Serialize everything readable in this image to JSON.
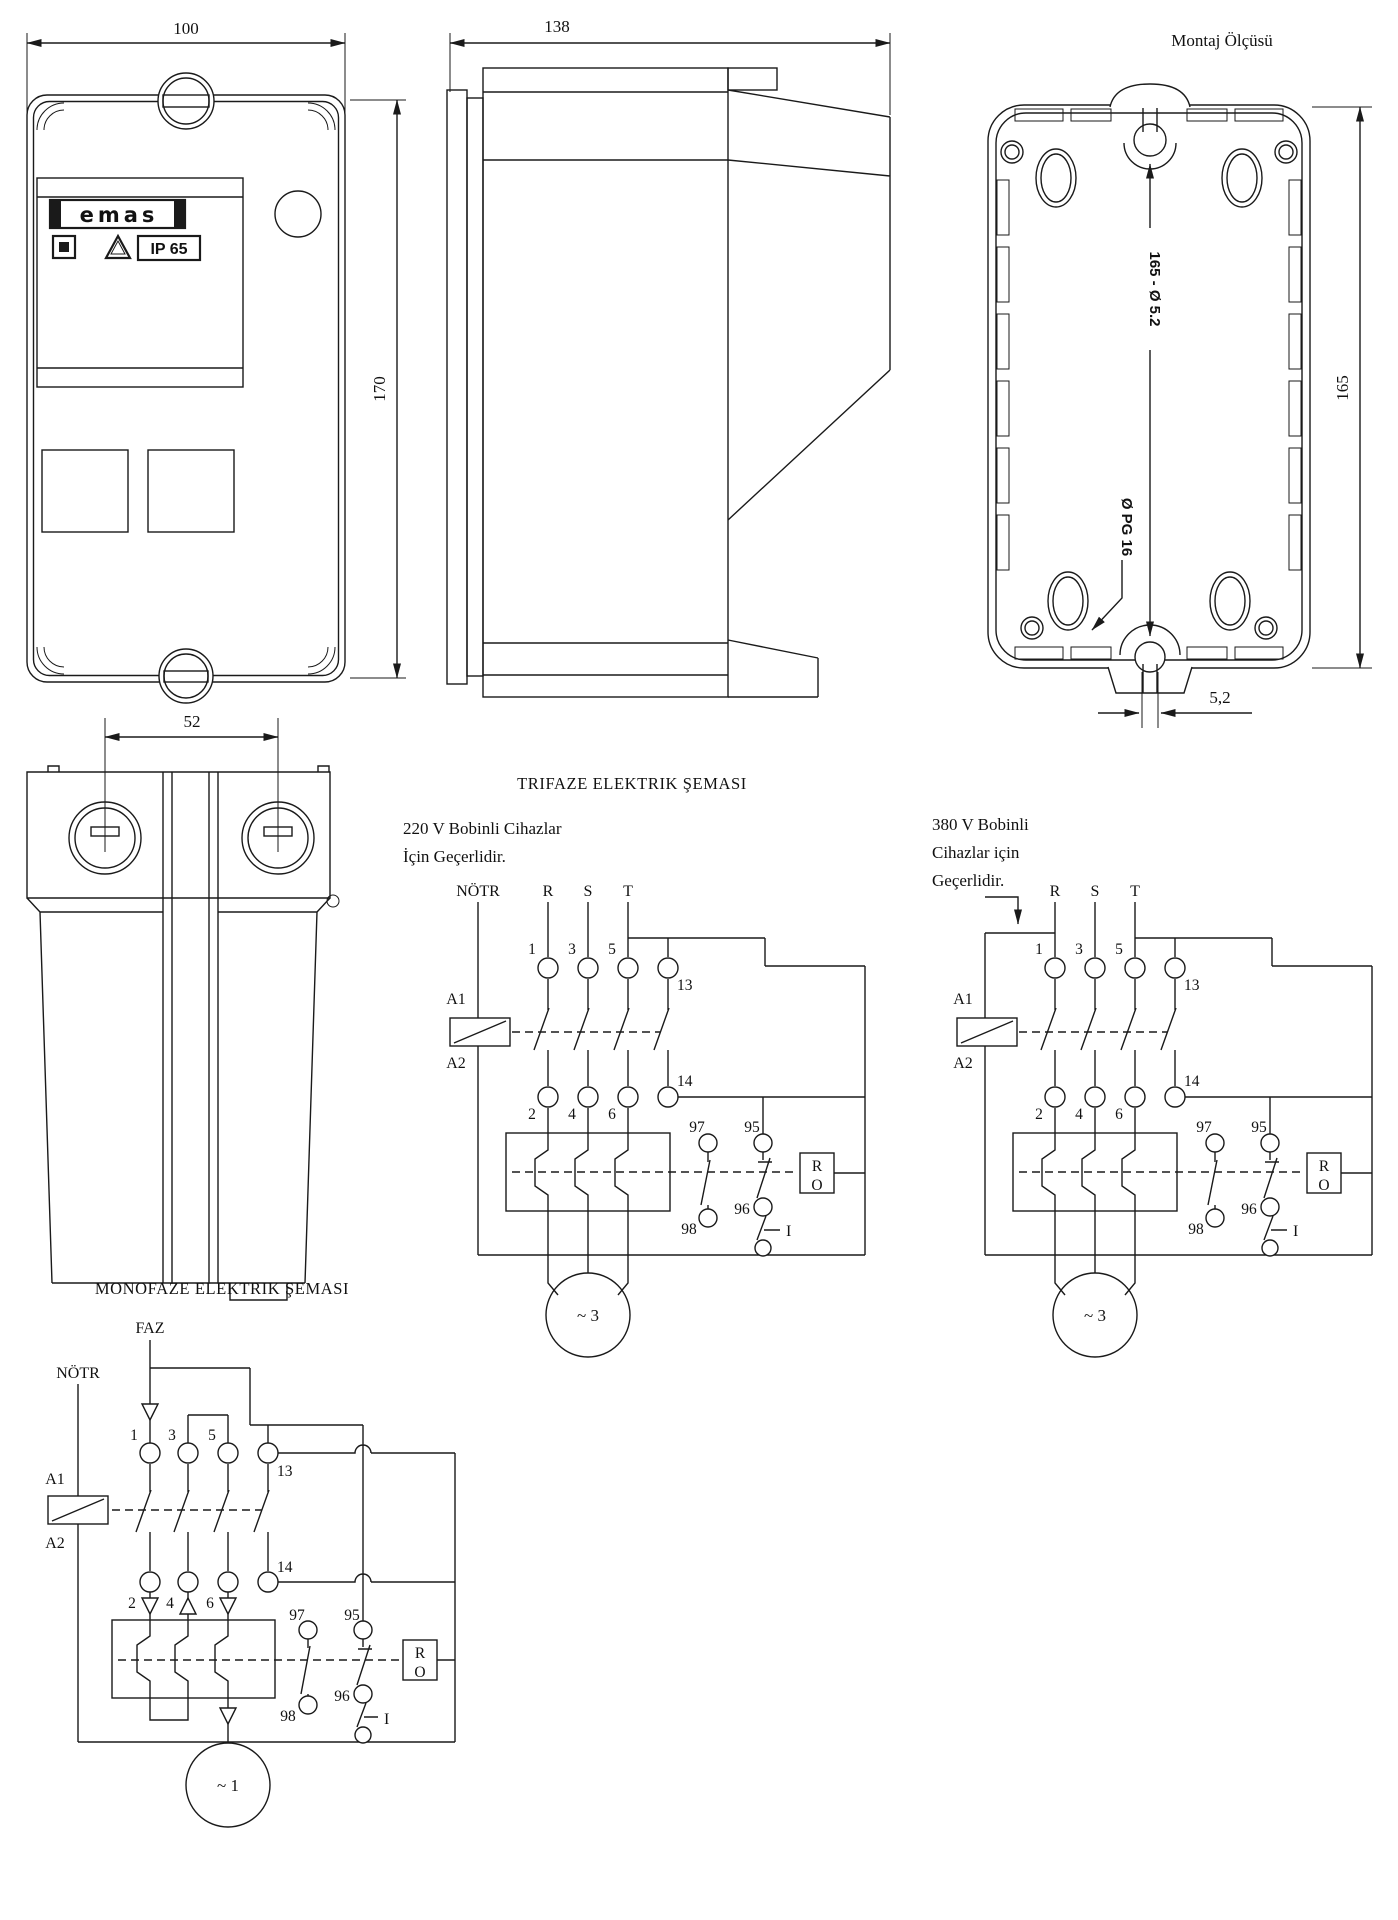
{
  "page": {
    "background": "#ffffff",
    "line_color": "#1a1a1a"
  },
  "views": {
    "front": {
      "dim_width": "100",
      "dim_height": "170",
      "logo_text": "emas",
      "ip_rating": "IP 65"
    },
    "side": {
      "dim_depth": "138"
    },
    "mounting": {
      "title": "Montaj Ölçüsü",
      "hole_note": "165 - Ø 5.2",
      "gland_note": "Ø PG 16",
      "dim_height": "165",
      "dim_slot_width": "5,2"
    },
    "bottom": {
      "dim_gland_spacing": "52"
    }
  },
  "schematics": {
    "trifaze_title": "TRIFAZE ELEKTRIK ŞEMASI",
    "monofaze_title": "MONOFAZE ELEKTRIK ŞEMASI",
    "v220_note": {
      "line1": "220 V Bobinli Cihazlar",
      "line2": "İçin Geçerlidir."
    },
    "v380_note": {
      "line1": "380 V Bobinli",
      "line2": "Cihazlar için",
      "line3": "Geçerlidir."
    },
    "labels": {
      "neutral": "NÖTR",
      "faz": "FAZ",
      "phase_r": "R",
      "phase_s": "S",
      "phase_t": "T",
      "t1": "1",
      "t2": "2",
      "t3": "3",
      "t4": "4",
      "t5": "5",
      "t6": "6",
      "aux13": "13",
      "aux14": "14",
      "a1": "A1",
      "a2": "A2",
      "no97": "97",
      "no98": "98",
      "nc95": "95",
      "nc96": "96",
      "reset_r": "R",
      "reset_o": "O",
      "start": "I",
      "motor_three": "~ 3",
      "motor_one": "~ 1"
    }
  }
}
